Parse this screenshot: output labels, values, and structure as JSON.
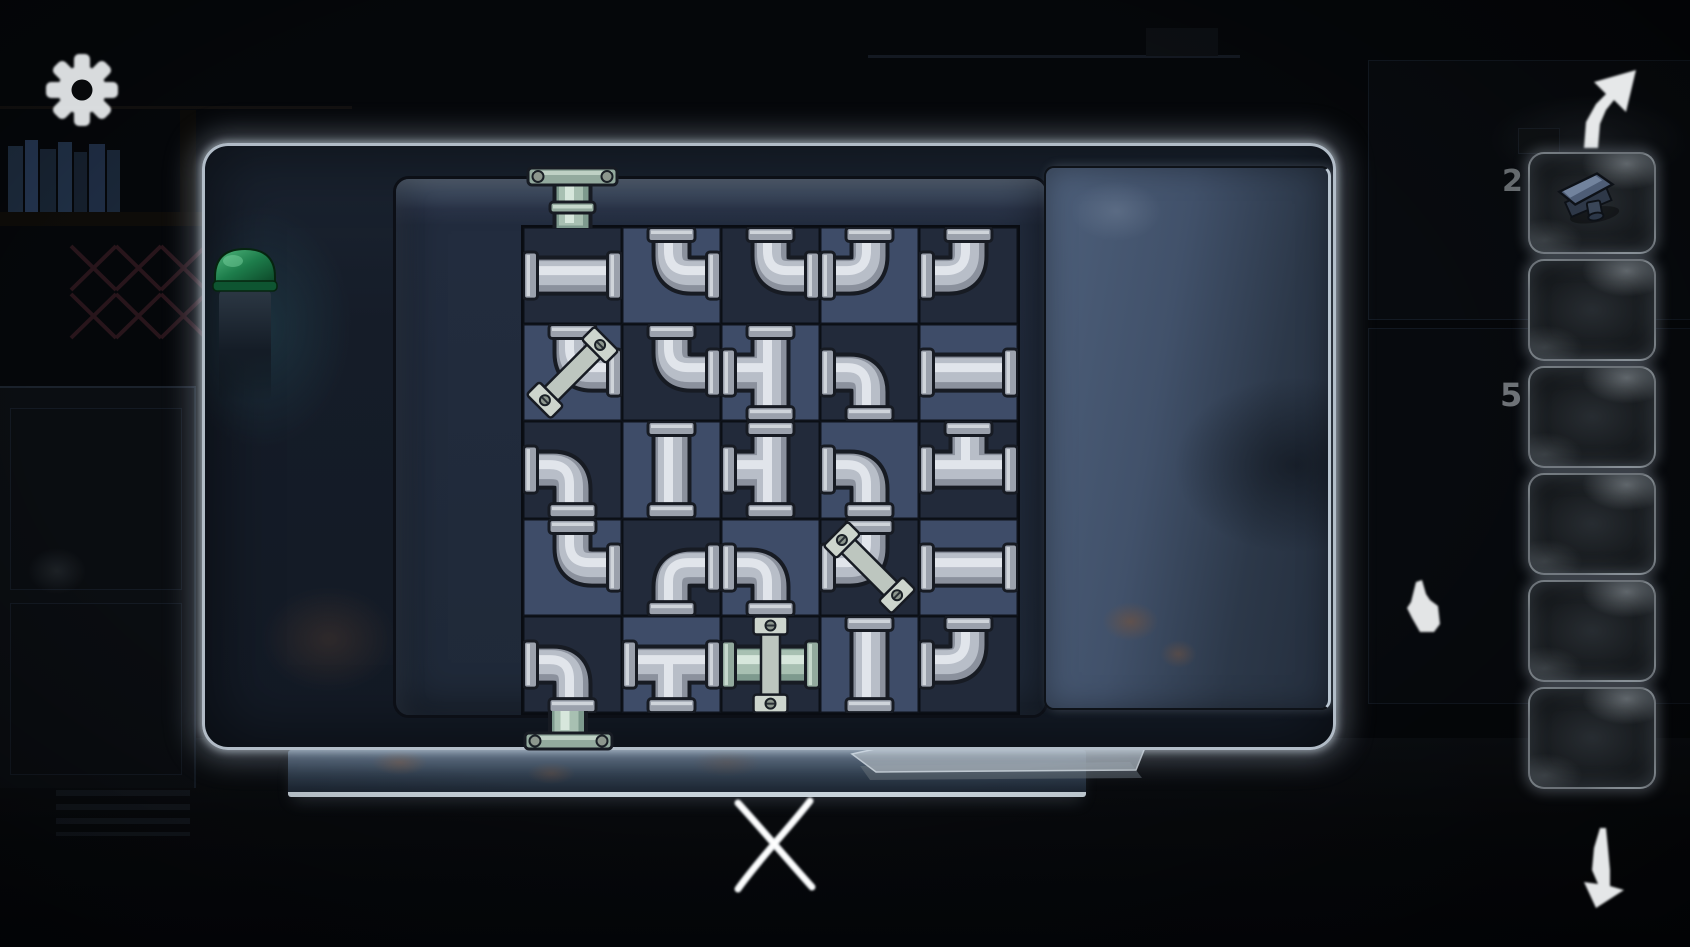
{
  "background": {
    "wall_digits": [
      "2",
      "5"
    ],
    "props": [
      "bookshelf",
      "lattice-grate",
      "green-capped-bottle",
      "cabinet",
      "table-with-papers",
      "wall-panels"
    ]
  },
  "hud": {
    "settings_icon": "gear-icon",
    "nav_up_icon": "curved-arrow-up-right-icon",
    "nav_down_icon": "curved-arrow-down-icon",
    "close_icon": "hand-drawn-x-icon",
    "cursor_icon": "hand-pointer-icon"
  },
  "inventory": {
    "slot_count": 6,
    "slots": [
      {
        "item": "metal-knob-handle"
      },
      {
        "item": null
      },
      {
        "item": null
      },
      {
        "item": null
      },
      {
        "item": null
      },
      {
        "item": null
      }
    ]
  },
  "puzzle": {
    "grid_rows": 5,
    "grid_cols": 5,
    "legend": {
      "o": "pipe openings: T top, R right, B bottom, L left",
      "brace": "diagonal lock-strap rotation in degrees",
      "green": "teal tinted pipe"
    },
    "inlet": {
      "position": "above column 1",
      "tint": "green"
    },
    "outlet": {
      "position": "below column 1",
      "tint": "green"
    },
    "cells": [
      [
        {
          "o": "LR"
        },
        {
          "o": "TR"
        },
        {
          "o": "TR"
        },
        {
          "o": "TL"
        },
        {
          "o": "TL"
        }
      ],
      [
        {
          "o": "TR",
          "brace": 45
        },
        {
          "o": "TR"
        },
        {
          "o": "TBL"
        },
        {
          "o": "LB"
        },
        {
          "o": "LR"
        }
      ],
      [
        {
          "o": "LB"
        },
        {
          "o": "TB"
        },
        {
          "o": "TBL"
        },
        {
          "o": "LB"
        },
        {
          "o": "TLR"
        }
      ],
      [
        {
          "o": "TR"
        },
        {
          "o": "RB"
        },
        {
          "o": "LB"
        },
        {
          "o": "TL",
          "brace": -45
        },
        {
          "o": "LR"
        }
      ],
      [
        {
          "o": "LB"
        },
        {
          "o": "LRB"
        },
        {
          "o": "LR",
          "brace": 0,
          "green": true
        },
        {
          "o": "TB"
        },
        {
          "o": "TL"
        }
      ]
    ]
  },
  "colors": {
    "pipe_outline": "#171b23",
    "pipe_base": "#8b919d",
    "pipe_light": "#b8bec8",
    "pipe_hi": "#e6e9ee",
    "pipe_flange": "#9ba1ac",
    "pipe_green_base": "#7e9a8e",
    "pipe_green_light": "#a8c0b2",
    "pipe_green_hi": "#dcebe0",
    "pipe_green_flange": "#93aa9e",
    "strap": "#bdc6bf",
    "strap_plate": "#cdd5cd",
    "screw": "#8d978e",
    "cell_dark": "#222a3a",
    "cell_light": "#3e4c68",
    "panel_glow": "#dde8f0",
    "flap_blue": "#41516a",
    "bottle_green": "#1d7d4b",
    "rust": "#6b4a35"
  }
}
